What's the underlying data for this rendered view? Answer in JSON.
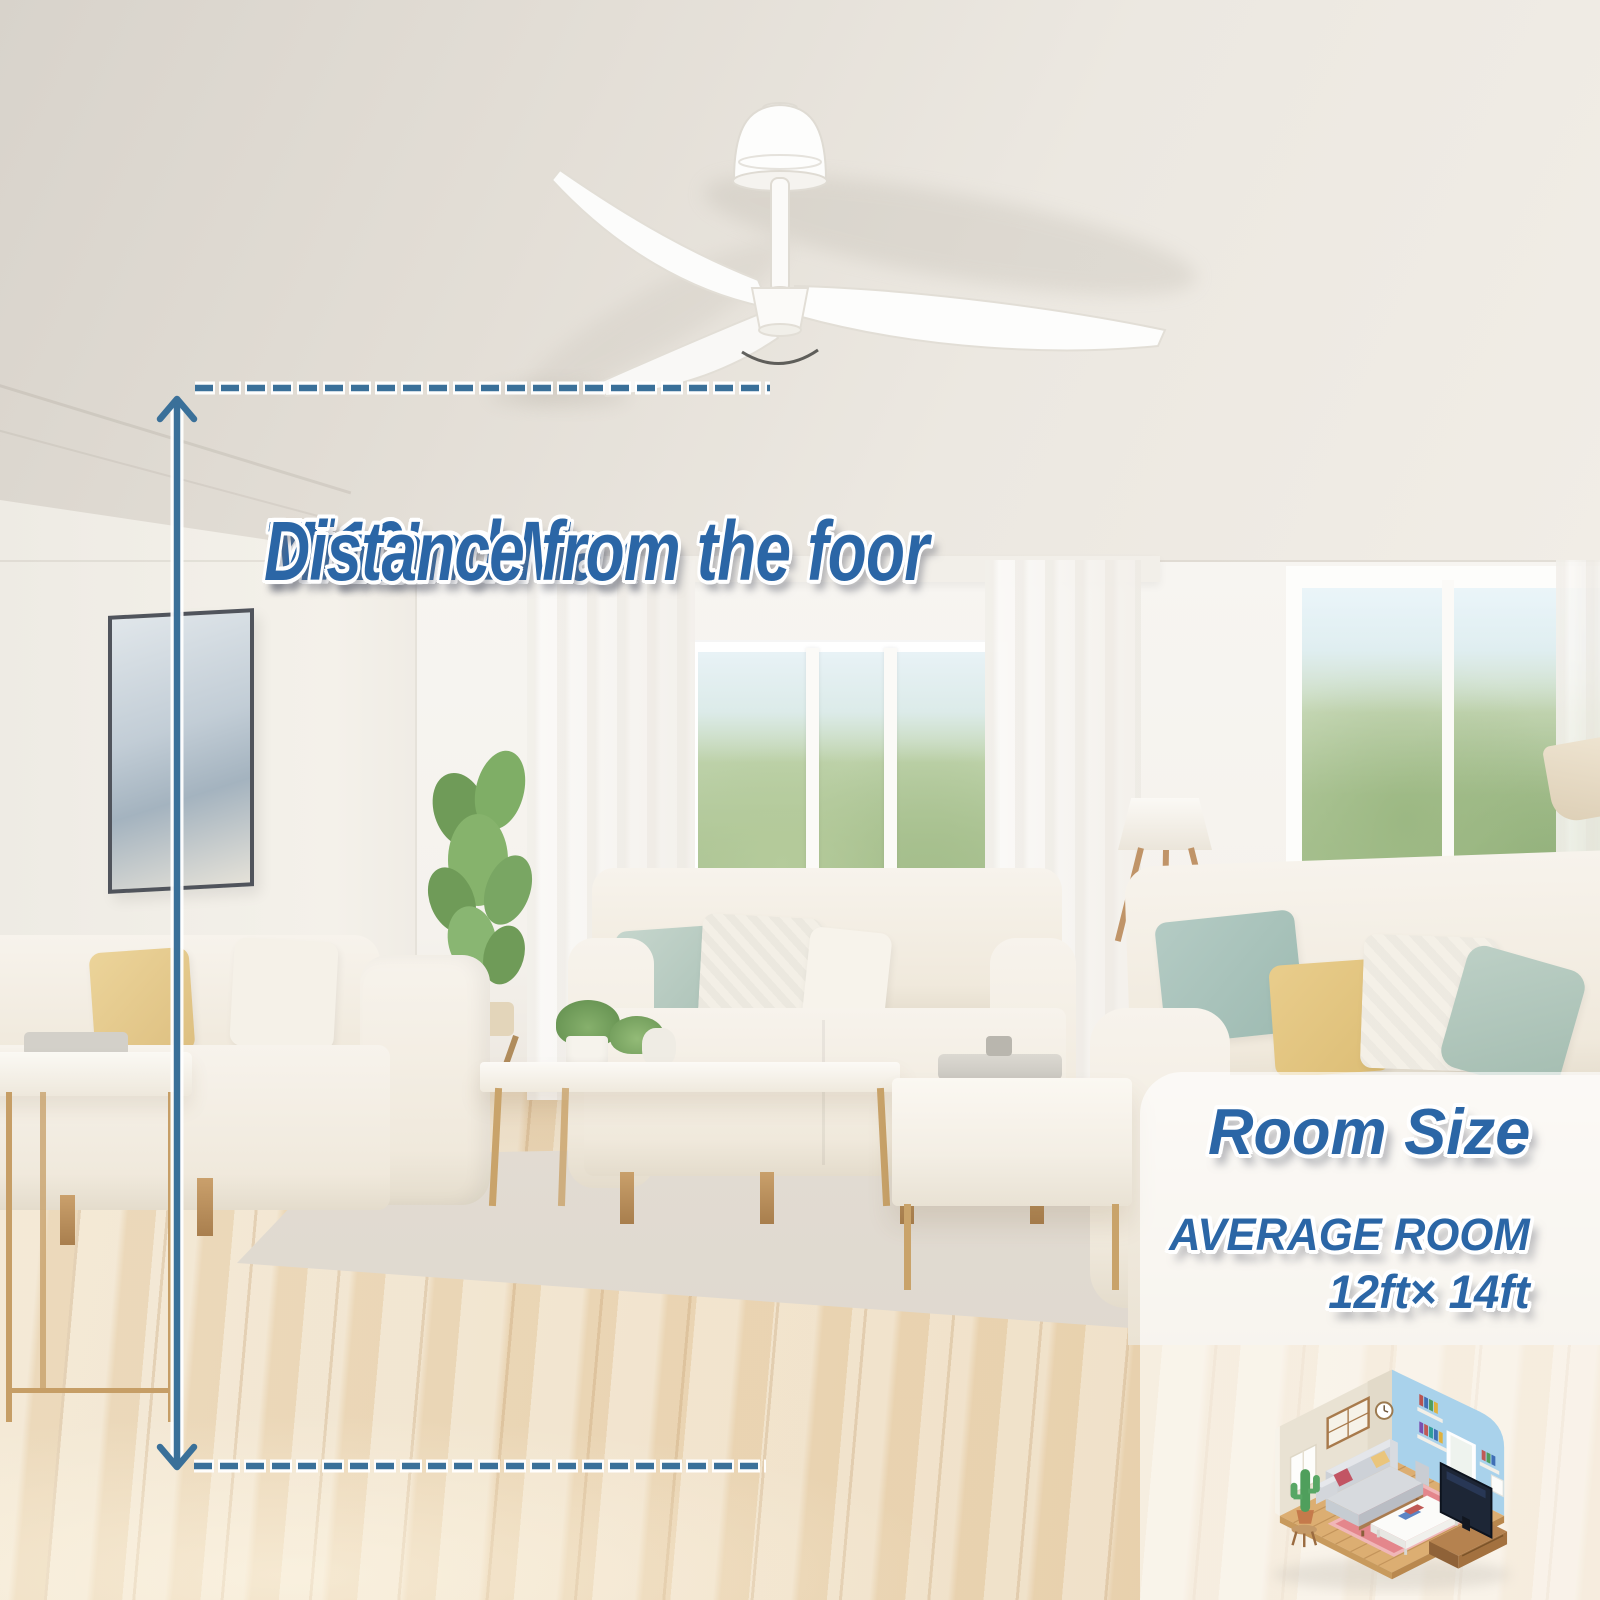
{
  "annotation": {
    "line1": "7'-10'",
    "line2": "Min and Max",
    "line3": "Distance from the foor"
  },
  "room_size": {
    "title": "Room Size",
    "subtitle": "AVERAGE ROOM",
    "dimensions": "12ft× 14ft"
  },
  "colors": {
    "label_blue": "#2b66a6",
    "measure_line_blue": "#3a7099",
    "overlay_panel": "rgba(255,255,255,0.62)"
  },
  "icons": {
    "measure_arrow_up": "arrow-up-icon",
    "measure_arrow_down": "arrow-down-icon",
    "ceiling_dashed_line": "dashed-line",
    "floor_dashed_line": "dashed-line",
    "room_illustration": "isometric-room"
  }
}
